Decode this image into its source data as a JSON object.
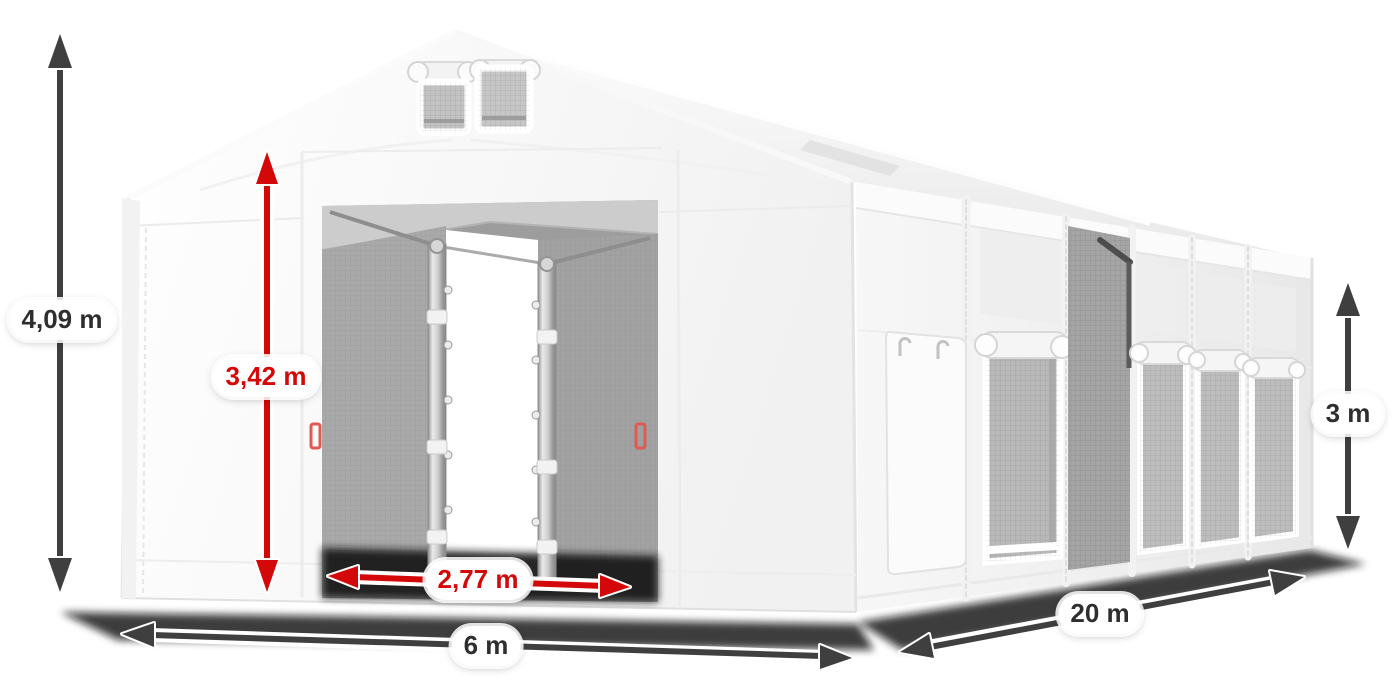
{
  "page": {
    "background": "#ffffff"
  },
  "diagram": {
    "kind": "tent-dimension-diagram",
    "colors": {
      "primary_arrow": "#3f3f3f",
      "accent_arrow": "#d40808",
      "label_bg": "#ffffff",
      "label_text": "#2e2e2e",
      "label_text_accent": "#d40808"
    },
    "dimensions": [
      {
        "id": "total-height",
        "label": "4,09 m",
        "style": "dark",
        "orientation": "vertical"
      },
      {
        "id": "door-height",
        "label": "3,42 m",
        "style": "red",
        "orientation": "vertical"
      },
      {
        "id": "door-width",
        "label": "2,77 m",
        "style": "red",
        "orientation": "horizontal"
      },
      {
        "id": "front-width",
        "label": "6 m",
        "style": "dark",
        "orientation": "horizontal"
      },
      {
        "id": "side-length",
        "label": "20 m",
        "style": "dark",
        "orientation": "diagonal"
      },
      {
        "id": "side-height",
        "label": "3 m",
        "style": "dark",
        "orientation": "vertical"
      }
    ]
  }
}
